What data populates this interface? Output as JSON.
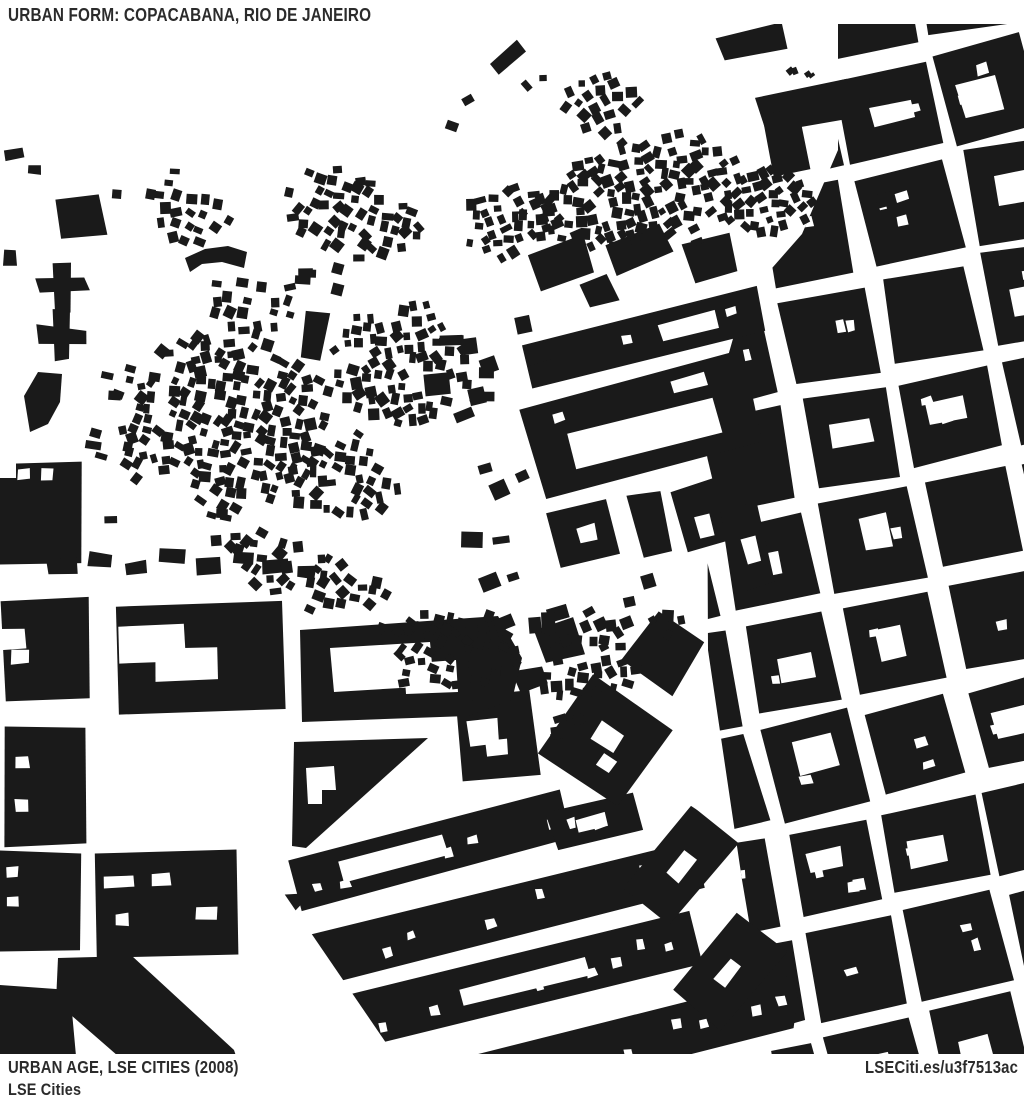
{
  "header": {
    "title": "URBAN FORM: COPACABANA, RIO DE JANEIRO"
  },
  "footer": {
    "credit_line1": "URBAN AGE, LSE CITIES (2008)",
    "credit_line2": "LSE Cities",
    "link": "LSECiti.es/u3f7513ac"
  },
  "theme": {
    "background": "#ffffff",
    "building_color": "#1a1a1a",
    "street_color": "#ffffff",
    "text_color": "#2b2b2b"
  }
}
